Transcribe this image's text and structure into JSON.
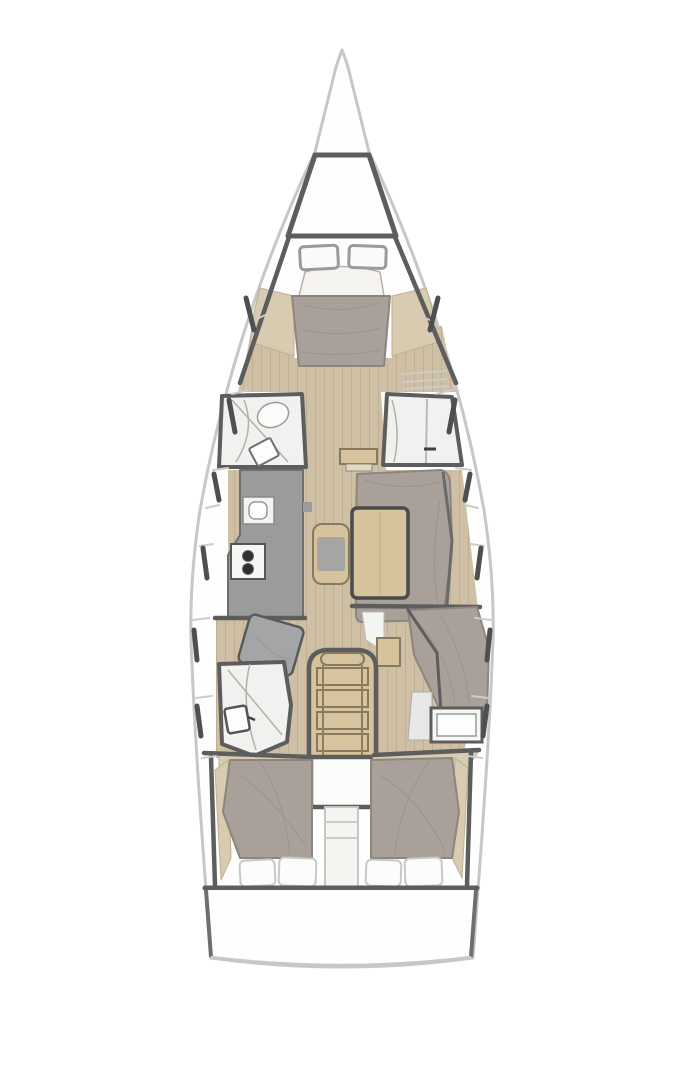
{
  "diagram": {
    "type": "yacht-interior-floor-plan",
    "label": "Sailing yacht interior layout, bow up, single deck",
    "orientation": "bow-up",
    "text_on_image": "none"
  },
  "palette": {
    "hull": "#c7c7c7",
    "wall": "#5d5d5d",
    "floor": "#cfc0a5",
    "plank": "#b3a186",
    "wood": "#d6c39c",
    "wood-edge": "#857a5f",
    "upholstery": "#a8a099",
    "counter": "#9b9b9b",
    "fixture": "#f4f4f2",
    "shelf": "#d9cbb0",
    "background": "#ffffff",
    "hatch-border": "#9a9a9a",
    "burner": "#2f2f2f",
    "panel-line": "#cccccc"
  },
  "vessel": {
    "areas": [
      {
        "id": "bow",
        "label": "bow-tip"
      },
      {
        "id": "foredeck",
        "label": "foredeck-anchor-locker"
      },
      {
        "id": "forward-cabin",
        "label": "forward-owner-cabin",
        "hatches": 2,
        "berth": "v-berth-double"
      },
      {
        "id": "port-forward-head",
        "label": "port-forward-head",
        "toilet": 1,
        "sink": 1
      },
      {
        "id": "starboard-forward-shower",
        "label": "starboard-forward-shower"
      },
      {
        "id": "galley",
        "label": "port-galley",
        "sink": 1,
        "stove_burners": 2
      },
      {
        "id": "salon",
        "label": "salon-starboard-settee",
        "table": 1,
        "bench": 1
      },
      {
        "id": "nav-station",
        "label": "port-nav-seat"
      },
      {
        "id": "aft-head",
        "label": "port-aft-head",
        "toilet": 1
      },
      {
        "id": "companionway",
        "label": "companionway-stairs",
        "steps": 4
      },
      {
        "id": "engine",
        "label": "engine-compartment"
      },
      {
        "id": "aft-cabin-port",
        "label": "aft-cabin-port",
        "berth": "double",
        "pillows": 2
      },
      {
        "id": "aft-cabin-starboard",
        "label": "aft-cabin-starboard",
        "berth": "double",
        "pillows": 2
      },
      {
        "id": "starboard-aft-vanity",
        "label": "starboard-aft-vanity-counter"
      },
      {
        "id": "transom",
        "label": "transom-swim-platform"
      }
    ]
  }
}
